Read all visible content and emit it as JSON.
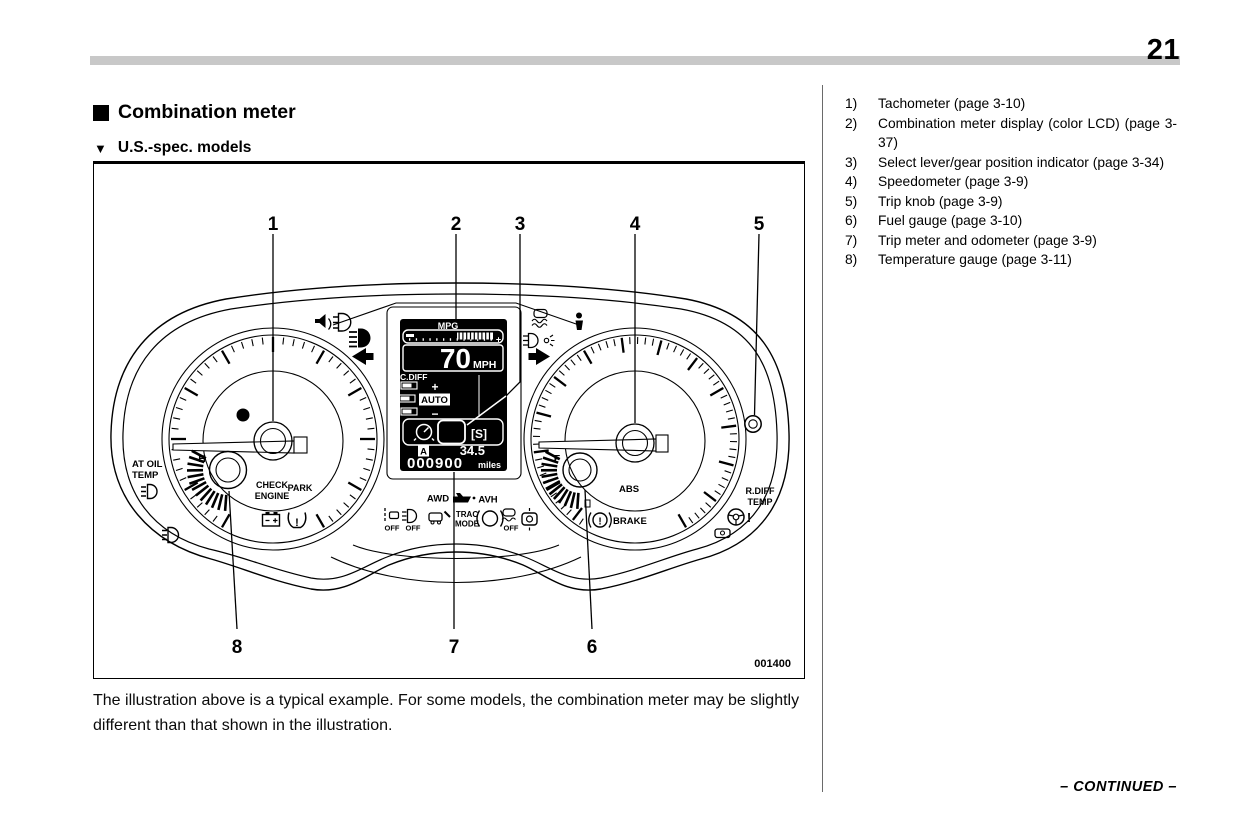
{
  "page": {
    "number": "21",
    "continued": "– CONTINUED –"
  },
  "header": {
    "section_title": "Combination meter",
    "section_marker": "■",
    "subsection_marker": "▼",
    "subsection_title": "U.S.-spec. models"
  },
  "caption": "The illustration above is a typical example. For some models, the combination meter may be slightly different than that shown in the illustration.",
  "list": {
    "items": [
      {
        "num": "1)",
        "text": "Tachometer (page 3-10)"
      },
      {
        "num": "2)",
        "text": "Combination meter display (color LCD) (page 3-37)"
      },
      {
        "num": "3)",
        "text": "Select lever/gear position indicator (page 3-34)"
      },
      {
        "num": "4)",
        "text": "Speedometer (page 3-9)"
      },
      {
        "num": "5)",
        "text": "Trip knob (page 3-9)"
      },
      {
        "num": "6)",
        "text": "Fuel gauge (page 3-10)"
      },
      {
        "num": "7)",
        "text": "Trip meter and odometer (page 3-9)"
      },
      {
        "num": "8)",
        "text": "Temperature gauge (page 3-11)"
      }
    ]
  },
  "figure": {
    "code": "001400",
    "callouts": [
      "1",
      "2",
      "3",
      "4",
      "5",
      "6",
      "7",
      "8"
    ],
    "labels": {
      "at_oil_1": "AT OIL",
      "at_oil_2": "TEMP",
      "h": "H",
      "f": "F",
      "check_1": "CHECK",
      "check_2": "ENGINE",
      "park": "PARK",
      "abs": "ABS",
      "brake": "BRAKE",
      "rdiff_1": "R.DIFF",
      "rdiff_2": "TEMP",
      "awd": "AWD",
      "avh": "AVH",
      "trac_1": "TRAC",
      "trac_2": "MODE",
      "off": "OFF"
    },
    "glyphs": {
      "excl": "!"
    },
    "lcd": {
      "mpg": "MPG",
      "bar_plus": "+",
      "speed": "70",
      "speed_unit": "MPH",
      "cdiff": "C.DIFF",
      "cd_plus": "+",
      "auto": "AUTO",
      "cd_minus": "−",
      "gear": "[S]",
      "trip_label": "A",
      "trip_value": "34.5",
      "odometer": "000900",
      "odo_unit": "miles"
    }
  }
}
